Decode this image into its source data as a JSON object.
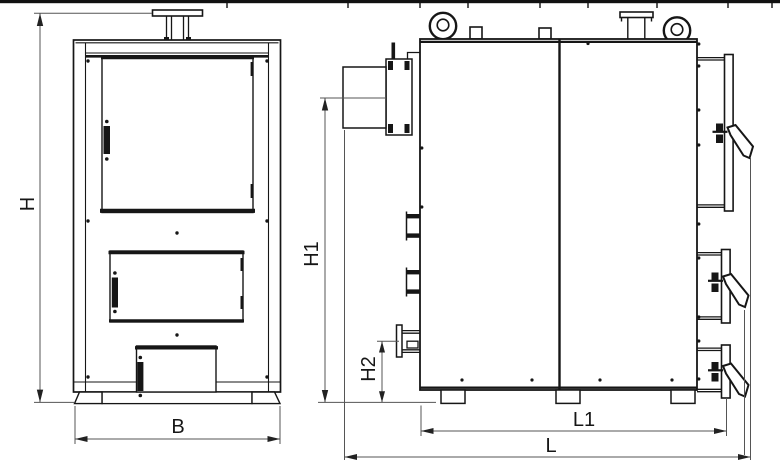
{
  "drawing": {
    "type": "boiler-dimension-drawing",
    "views": {
      "left": "front-view",
      "right": "side-view"
    },
    "dimension_labels": {
      "front_height": "H",
      "front_width": "B",
      "side_flue_height": "H1",
      "side_pipe_height": "H2",
      "side_base_length": "L1",
      "side_total_length": "L"
    },
    "colors": {
      "line": "#161616",
      "dimension_line": "#555555",
      "arrow": "#222222",
      "background": "#ffffff"
    }
  }
}
